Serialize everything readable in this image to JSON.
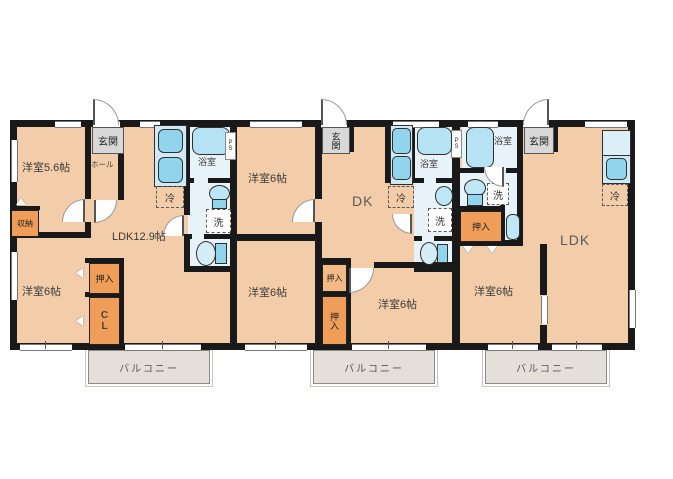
{
  "colors": {
    "floor": "#f3cda9",
    "wet_floor": "#e8f3f9",
    "fixture_light": "#bfe6f5",
    "fixture_mid": "#92d4ec",
    "closet_orange": "#f09d59",
    "closet_light_orange": "#f4ba85",
    "entry_gray": "#d8d8d8",
    "balcony_gray": "#e4dfd8",
    "wall_black": "#191919"
  },
  "units": {
    "u1": {
      "room1": "洋室5.6帖",
      "entry": "玄関",
      "hall": "ホール",
      "bath": "浴室",
      "fridge": "冷",
      "laundry": "洗",
      "ps": "PS",
      "living": "LDK12.9帖",
      "storage": "収納",
      "closet": "押入",
      "cl": "CL",
      "room2": "洋室6帖",
      "balcony": "バルコニー"
    },
    "u2": {
      "entry": "玄関",
      "room1": "洋室6帖",
      "bath": "浴室",
      "fridge": "冷",
      "laundry": "洗",
      "dining": "DK",
      "ps": "PS",
      "closet_upper": "押入",
      "closet_lower": "押入",
      "room2": "洋室6帖",
      "room3": "洋室6帖",
      "balcony": "バルコニー"
    },
    "u3": {
      "entry": "玄関",
      "bath": "浴室",
      "laundry": "洗",
      "fridge": "冷",
      "closet": "押入",
      "living": "LDK",
      "room1": "洋室6帖",
      "balcony": "バルコニー"
    }
  }
}
